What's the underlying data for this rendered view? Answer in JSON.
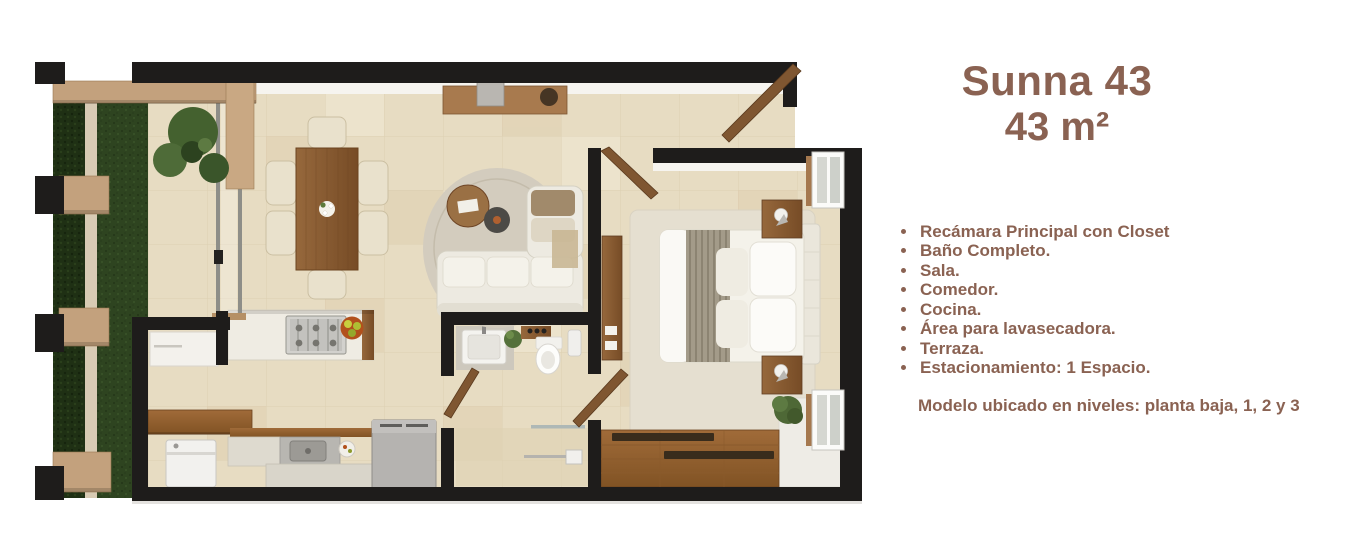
{
  "panel": {
    "title": "Sunna 43",
    "subtitle": "43 m²",
    "features": [
      "Recámara Principal con Closet",
      "Baño Completo.",
      "Sala.",
      "Comedor.",
      "Cocina.",
      "Área para lavasecadora.",
      "Terraza.",
      "Estacionamiento: 1 Espacio."
    ],
    "note": "Modelo ubicado en niveles: planta baja, 1, 2 y 3",
    "text_color": "#8a6252"
  },
  "floorplan": {
    "description": "top-view 3D rendered apartment floor plan",
    "colors": {
      "wall": "#1e1c1b",
      "floor_tile": "#e7dcc2",
      "wood": "#8a5f38",
      "pergola_wood": "#c3a17d",
      "grass": "#2e4420",
      "hedge": "#1f3014",
      "sofa": "#edeae1",
      "appliance_gray": "#b5b3b0",
      "background": "#ffffff"
    }
  }
}
